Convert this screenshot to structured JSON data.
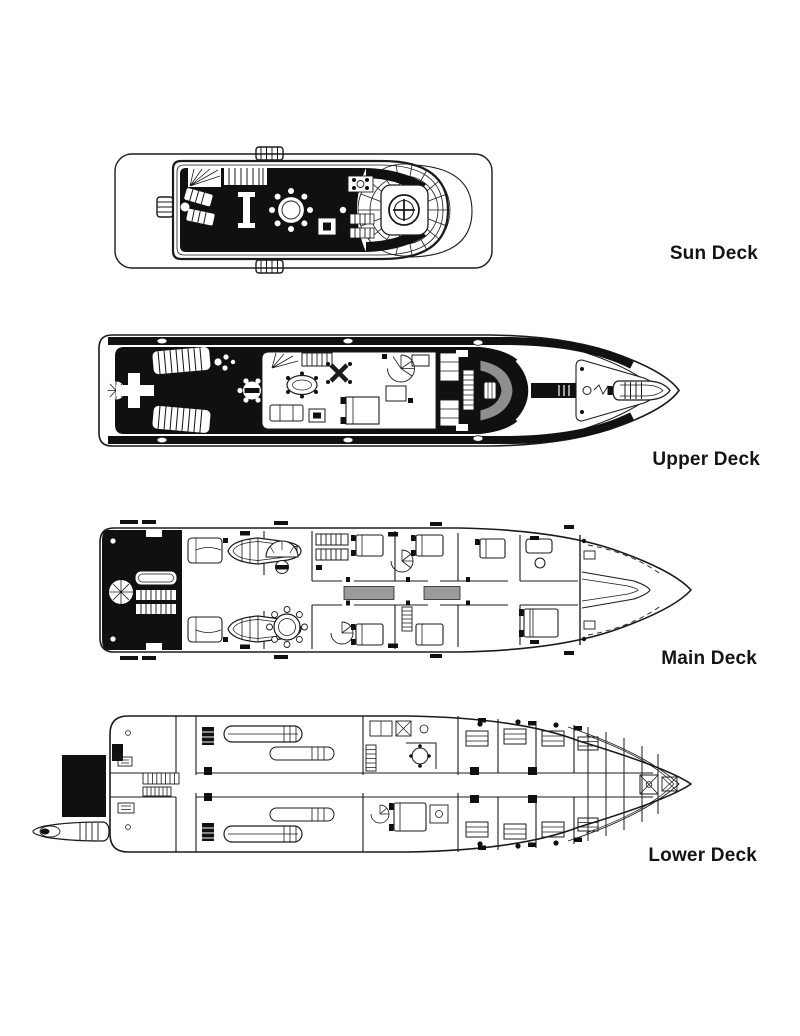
{
  "page": {
    "background": "#ffffff",
    "line_color": "#1b1b1b",
    "fill_black": "#101010",
    "corridor_gray": "#9b9b9b"
  },
  "decks": [
    {
      "id": "sun-deck",
      "label": "Sun Deck"
    },
    {
      "id": "upper-deck",
      "label": "Upper Deck"
    },
    {
      "id": "main-deck",
      "label": "Main Deck"
    },
    {
      "id": "lower-deck",
      "label": "Lower Deck"
    }
  ]
}
